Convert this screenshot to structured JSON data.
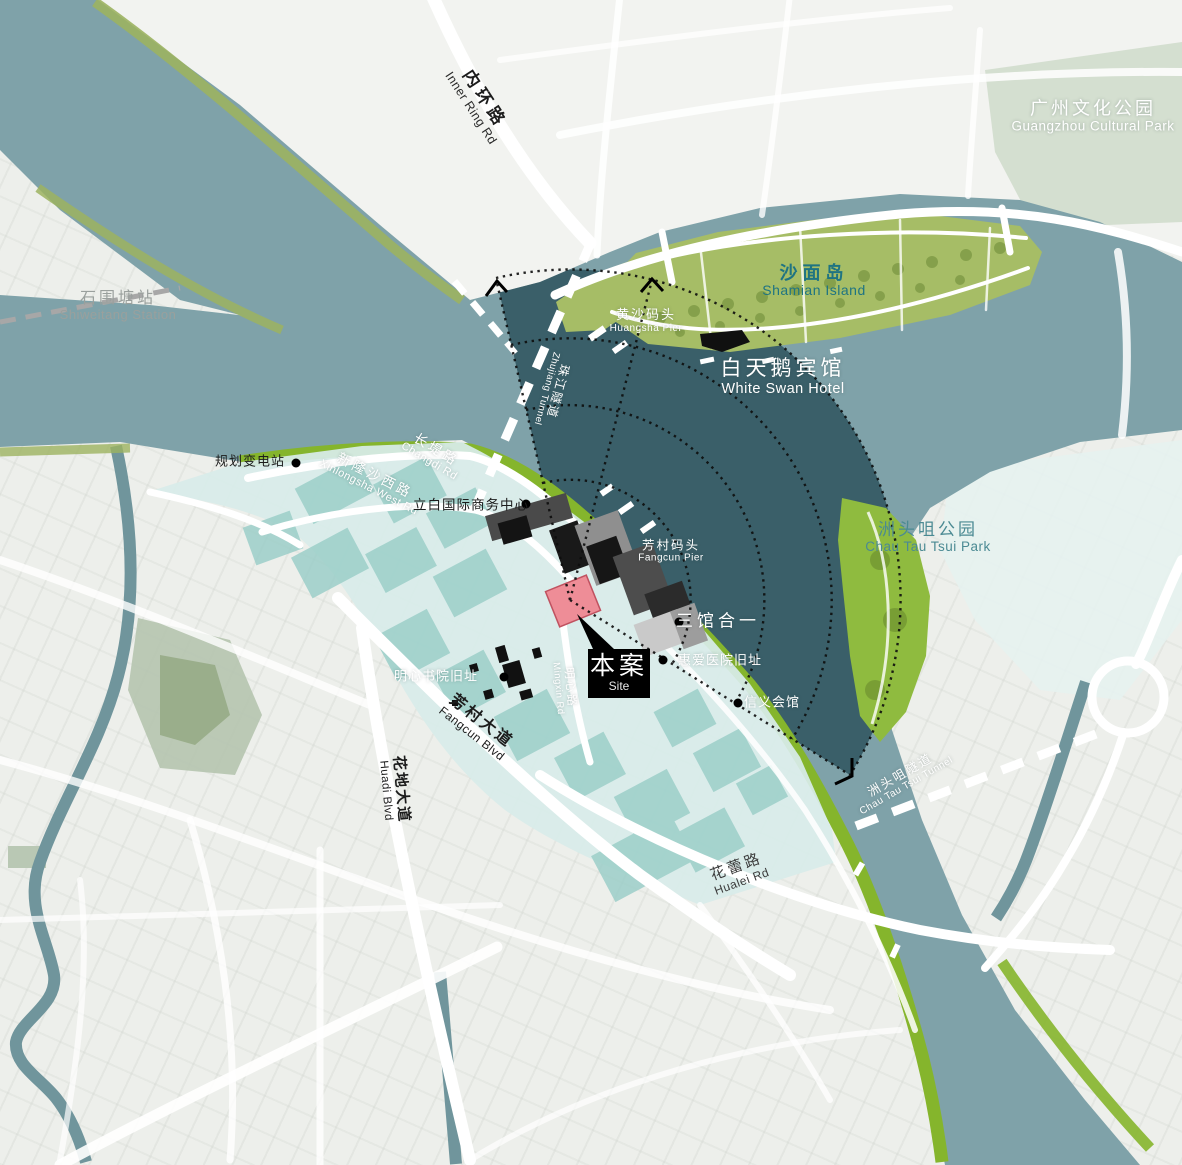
{
  "labels": {
    "inner_ring_rd": {
      "zh": "内环路",
      "en": "Inner Ring Rd"
    },
    "guangzhou_cultural_park": {
      "zh": "广州文化公园",
      "en": "Guangzhou Cultural Park"
    },
    "shiweitang_station": {
      "zh": "石围塘站",
      "en": "Shiweitang Station"
    },
    "shamian_island": {
      "zh": "沙面岛",
      "en": "Shamian Island"
    },
    "white_swan_hotel": {
      "zh": "白天鹅宾馆",
      "en": "White Swan Hotel"
    },
    "huangsha_pier": {
      "zh": "黄沙码头",
      "en": "Huangsha Pier"
    },
    "zhujiang_tunnel": {
      "zh": "珠江隧道",
      "en": "Zhujiang Tunnel"
    },
    "planned_substation": {
      "zh": "规划变电站"
    },
    "changdi_rd": {
      "zh": "长堤路",
      "en": "Changdi Rd"
    },
    "xinlongsha_west_rd": {
      "zh": "新隆沙西路",
      "en": "Xinlongsha West Rd"
    },
    "liby_intl_business_center": {
      "zh": "立白国际商务中心"
    },
    "fangcun_pier": {
      "zh": "芳村码头",
      "en": "Fangcun Pier"
    },
    "three_museums_in_one": {
      "zh": "三馆合一"
    },
    "site": {
      "zh": "本案",
      "en": "Site"
    },
    "huiai_hospital_site": {
      "zh": "惠爱医院旧址"
    },
    "xinyi_hall": {
      "zh": "信义会馆"
    },
    "mingxin_academy_site": {
      "zh": "明心书院旧址"
    },
    "mingxin_rd": {
      "zh": "明心路",
      "en": "Mingxin Rd"
    },
    "fangcun_blvd": {
      "zh": "芳村大道",
      "en": "Fangcun Blvd"
    },
    "huadi_blvd": {
      "zh": "花地大道",
      "en": "Huadi Blvd"
    },
    "hualei_rd": {
      "zh": "花蕾路",
      "en": "Hualei Rd"
    },
    "chau_tau_tsui_park": {
      "zh": "洲头咀公园",
      "en": "Chau Tau Tsui Park"
    },
    "chau_tau_tsui_tunnel": {
      "zh": "洲头咀隧道",
      "en": "Chau Tau Tsui Tunnel"
    }
  },
  "colors": {
    "river": "#7fa2a9",
    "view_cone": "#3a5f6a",
    "waterfront_green": "#85b52c",
    "island_green": "#a6bd66",
    "development_teal": "#d8ece9",
    "block_teal": "#98cdc7",
    "site_pink": "#ee8d97",
    "label_teal": "#1f7482",
    "city_background": "#edefeb"
  }
}
